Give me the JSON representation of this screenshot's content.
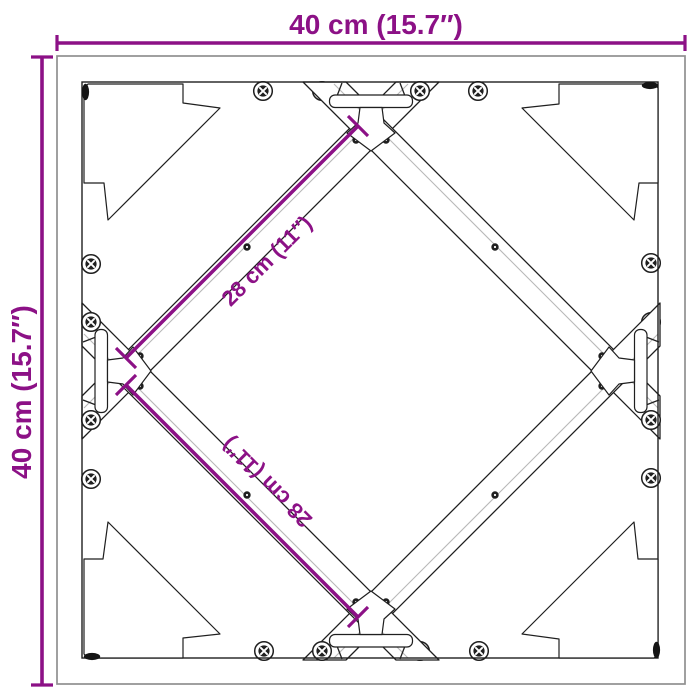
{
  "diagram": {
    "title": "square table frame top view with cross braces",
    "annotations": {
      "width": "40 cm (15.7″)",
      "height": "40 cm (15.7″)",
      "diagonal_upper": "28 cm (11″)",
      "diagonal_lower": "28 cm (11″)"
    },
    "colors": {
      "dimension_accent": "#8c1186",
      "line_dark": "#1f1f1f",
      "line_gray": "#909090",
      "background": "#ffffff"
    }
  }
}
